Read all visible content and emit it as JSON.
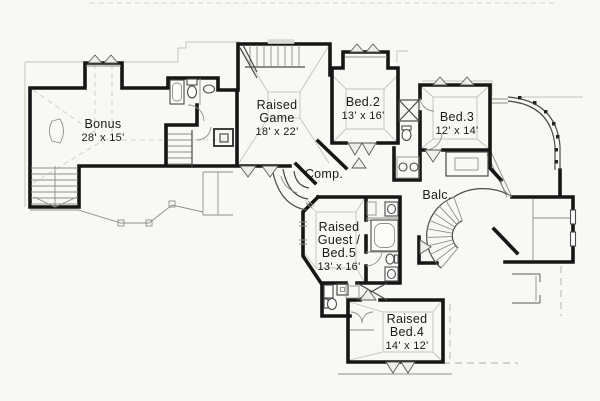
{
  "colors": {
    "background": "#f8f8f5",
    "walls": "#161616",
    "light_lines": "#c3c3bb"
  },
  "rooms": {
    "bonus": {
      "name": "Bonus",
      "dims": "28' x 15'"
    },
    "game": {
      "name_line1": "Raised",
      "name_line2": "Game",
      "dims": "18' x 22'"
    },
    "bed2": {
      "name": "Bed.2",
      "dims": "13' x 16'"
    },
    "bed3": {
      "name": "Bed.3",
      "dims": "12' x 14'"
    },
    "comp": {
      "name": "Comp."
    },
    "balcony": {
      "name": "Balc."
    },
    "guest": {
      "name_line1": "Raised",
      "name_line2": "Guest /",
      "name_line3": "Bed.5",
      "dims": "13' x 16'"
    },
    "bed4": {
      "name_line1": "Raised",
      "name_line2": "Bed.4",
      "dims": "14' x 12'"
    }
  }
}
